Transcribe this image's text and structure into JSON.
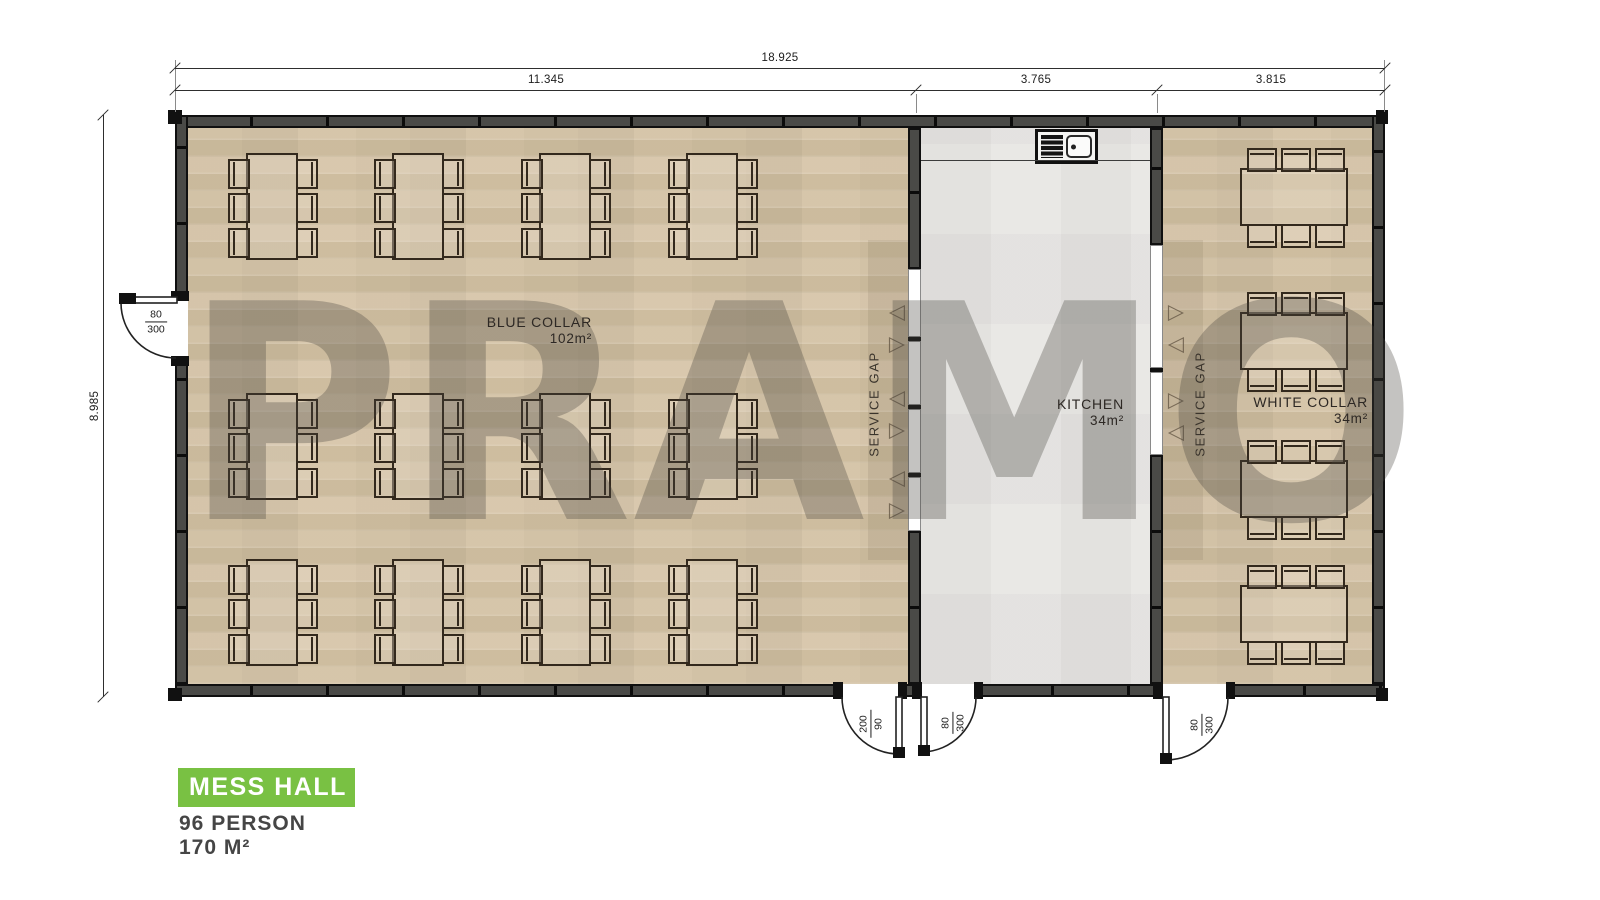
{
  "watermark": "PRAMO",
  "dimensions": {
    "total": "18.925",
    "segments": [
      "11.345",
      "3.765",
      "3.815"
    ],
    "height": "8.985"
  },
  "rooms": {
    "blue_collar": {
      "name": "BLUE COLLAR",
      "area": "102m²",
      "tables": 12,
      "chairs_per_table": 6
    },
    "kitchen": {
      "name": "KITCHEN",
      "area": "34m²"
    },
    "white_collar": {
      "name": "WHITE COLLAR",
      "area": "34m²",
      "tables": 4,
      "chairs_per_table": 6
    }
  },
  "labels": {
    "service_gap": "SERVICE GAP"
  },
  "doors": {
    "left": {
      "num": "80",
      "den": "300"
    },
    "bottom_blue": {
      "num": "200",
      "den": "90"
    },
    "bottom_kitchen": {
      "num": "80",
      "den": "300"
    },
    "bottom_white": {
      "num": "80",
      "den": "300"
    }
  },
  "fixtures": {
    "sink": "kitchen-sink"
  },
  "legend": {
    "title": "MESS HALL",
    "capacity": "96 PERSON",
    "area": "170 M²",
    "accent_color": "#79C143"
  }
}
